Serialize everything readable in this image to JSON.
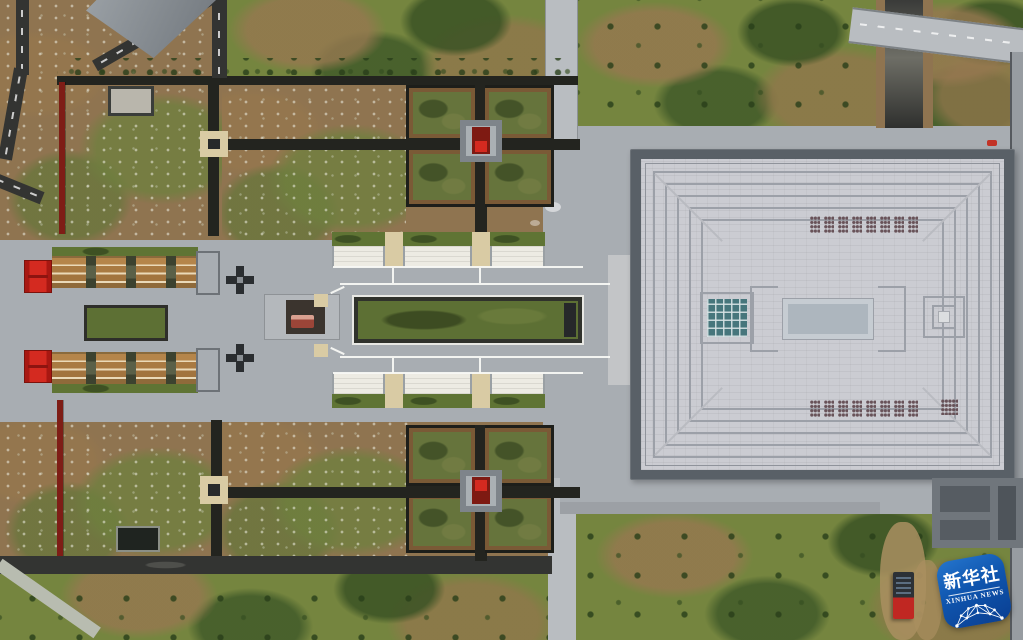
{
  "image": {
    "type": "aerial-photograph",
    "subject": "memorial park complex with ceremonial axis, cross-shaped gardens, covered corridors and a large square-roofed main hall",
    "watermark": {
      "agency_cn": "新华社",
      "agency_en": "XINHUA NEWS"
    }
  },
  "palette": {
    "dirt": "#8f7450",
    "grass-bright": "#75853f",
    "grass-dark": "#46602c",
    "road-dark": "#333432",
    "path-dark": "#23241f",
    "paving": "#a8adb2",
    "paving-light": "#b9bdc1",
    "roof-light": "#cbccd2",
    "roof-line": "#9ca0a8",
    "roof-edge": "#596067",
    "corridor-tan": "#ad7a41",
    "corridor-stripe": "#ead9b8",
    "canopy-white": "#edebe3",
    "strip-green": "#5f7434",
    "lawn-green": "#5d7034",
    "quad-border": "#7a5a36",
    "gate-red": "#d42a20",
    "wall-red": "#7e1d16",
    "node-tan": "#d9cba4",
    "teal-grid": "#47767c",
    "center-court": "#adb6be",
    "badge-blue1": "#2474cc",
    "badge-blue2": "#0a3f92",
    "truck-red": "#c02722"
  }
}
